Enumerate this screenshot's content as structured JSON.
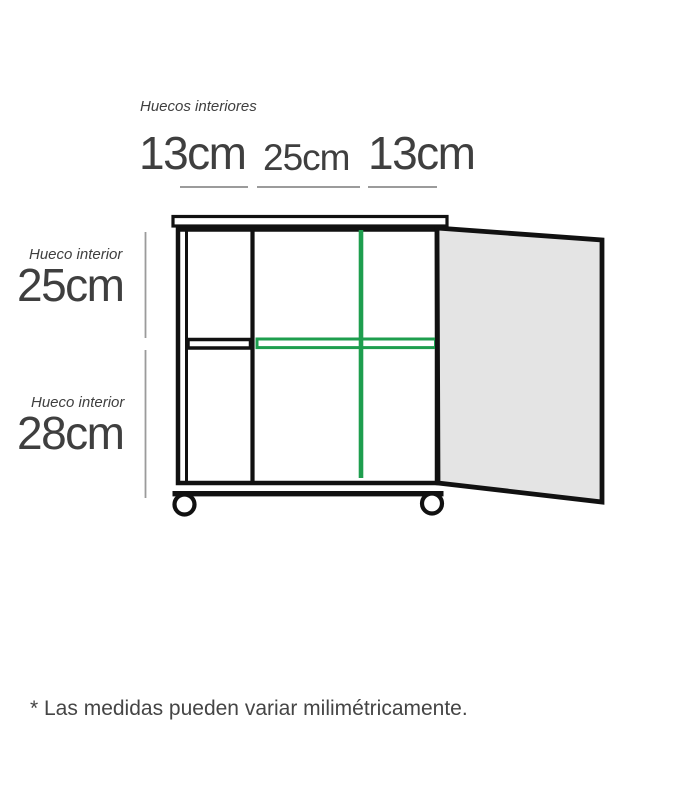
{
  "top_measurements": {
    "label": "Huecos interiores",
    "values": [
      "13cm",
      "25cm",
      "13cm"
    ]
  },
  "side_measurements": [
    {
      "label": "Hueco interior",
      "value": "25cm"
    },
    {
      "label": "Hueco interior",
      "value": "28cm"
    }
  ],
  "footnote": "* Las medidas pueden variar milimétricamente.",
  "diagram": {
    "type": "furniture-dimension-diagram",
    "subject": "mobile cabinet with open door, two casters, interior shelf highlighted in green"
  },
  "colors": {
    "accent_green": "#1e9e4e",
    "line_black": "#111111",
    "text_dark": "#3f3f3f",
    "measure_gray": "#9b9b9b",
    "door_fill": "#e4e4e4",
    "footnote_gray": "#454545"
  }
}
